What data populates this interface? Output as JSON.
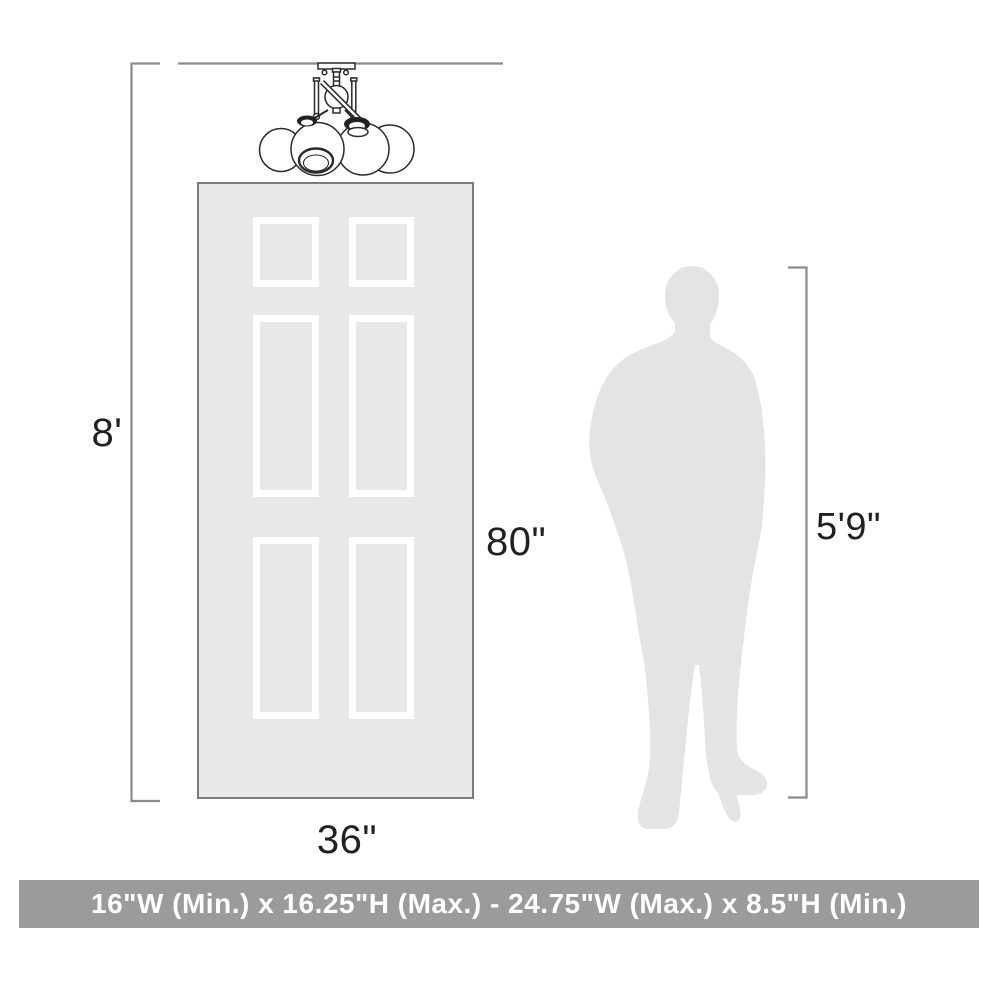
{
  "diagram": {
    "ceiling": {
      "height_label": "8'"
    },
    "door": {
      "height_label": "80\"",
      "width_label": "36\""
    },
    "person": {
      "height_label": "5'9\""
    },
    "fixture": {
      "icon": "semi-flush-mount-light-drawing"
    },
    "colors": {
      "dimension_line": "#8a8a8a",
      "label_text": "#231f20",
      "door_fill": "#e8e8e8",
      "door_border": "#7c7c7c",
      "panel_frame": "#ffffff",
      "silhouette_fill": "#e4e4e4",
      "fixture_stroke": "#2a2a2a",
      "banner_background": "#9b9b9b",
      "banner_text_color": "#ffffff"
    }
  },
  "banner": {
    "text": "16\"W (Min.) x 16.25\"H (Max.) - 24.75\"W (Max.) x 8.5\"H (Min.)"
  }
}
